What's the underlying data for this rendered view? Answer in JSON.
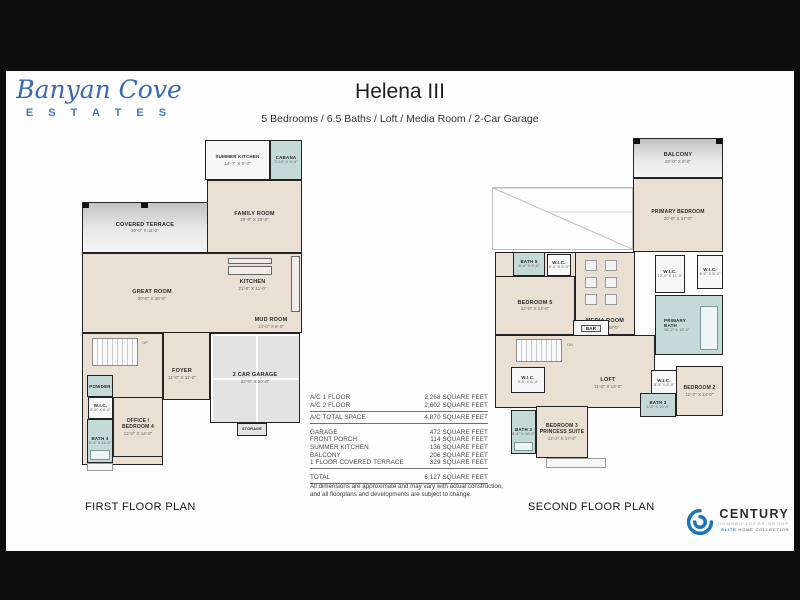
{
  "colors": {
    "brand_blue": "#3a68b5",
    "century_blue": "#1b75bc",
    "room_beige": "#e9e0d3",
    "bath_teal": "#c3dad6"
  },
  "brand": {
    "line1": "Banyan Cove",
    "line2": "E S T A T E S"
  },
  "header": {
    "title": "Helena III",
    "subtitle": "5 Bedrooms / 6.5 Baths / Loft / Media Room / 2-Car Garage"
  },
  "first_floor": {
    "caption": "FIRST FLOOR PLAN",
    "rooms": {
      "summer_kitchen": {
        "name": "SUMMER KITCHEN",
        "dims": "14'-7\" X 9'-4\""
      },
      "cabana": {
        "name": "CABANA",
        "dims": "5'-10\" X 9'-4\""
      },
      "covered_terrace": {
        "name": "COVERED TERRACE",
        "dims": "30'-0\" X 11'-2\""
      },
      "family_room": {
        "name": "FAMILY ROOM",
        "dims": "20'-0\" X 20'-0\""
      },
      "great_room": {
        "name": "GREAT ROOM",
        "dims": "20'-6\" X 20'-6\""
      },
      "kitchen": {
        "name": "KITCHEN",
        "dims": "21'-0\" X 11'-0\""
      },
      "mud_room": {
        "name": "MUD ROOM",
        "dims": "14'-0\" X 6'-0\""
      },
      "foyer": {
        "name": "FOYER",
        "dims": "11'-0\" X 11'-0\""
      },
      "garage": {
        "name": "2  CAR GARAGE",
        "dims": "22'-0\" X 20'-0\""
      },
      "storage": {
        "name": "STORAGE"
      },
      "powder": {
        "name": "POWDER"
      },
      "wic": {
        "name": "W.I.C.",
        "dims": "5'-8\" X 6'-0\""
      },
      "bath4": {
        "name": "BATH 4",
        "dims": "5'-4\" X 11'-0\""
      },
      "office": {
        "name1": "OFFICE /",
        "name2": "BEDROOM 4",
        "dims": "12'-0\" X 14'-0\""
      },
      "up": "UP"
    }
  },
  "second_floor": {
    "caption": "SECOND FLOOR PLAN",
    "rooms": {
      "balcony": {
        "name": "BALCONY",
        "dims": "20'-0\" X 8'-0\""
      },
      "primary_bedroom": {
        "name": "PRIMARY BEDROOM",
        "dims": "20'-8\" X 17'-0\""
      },
      "bath5": {
        "name": "BATH 5",
        "dims": "6'-4\" X 9'-0\""
      },
      "wic5": {
        "name": "W.I.C.",
        "dims": "6'-0\" X 5'-0\""
      },
      "bedroom5": {
        "name": "BEDROOM 5",
        "dims": "12'-0\" X 14'-0\""
      },
      "media_room": {
        "name": "MEDIA ROOM",
        "dims": "18'-4\" X 18'-0\""
      },
      "wic_primary_1": {
        "name": "W.I.C.",
        "dims": "12'-0\" X 11'-0\""
      },
      "wic_primary_2": {
        "name": "W.I.C.",
        "dims": "6'-2\" X 5'-0\""
      },
      "primary_bath": {
        "name": "PRIMARY",
        "name2": "BATH",
        "dims": "16'-2\" X 12'-0\""
      },
      "bar": {
        "name": "BAR"
      },
      "loft": {
        "name": "LOFT",
        "dims": "11'-0\" X 13'-0\""
      },
      "wic_left": {
        "name": "W.I.C.",
        "dims": "9'-0\" X 6'-4\""
      },
      "wic_mid": {
        "name": "W.I.C.",
        "dims": "8'-4\" X 5'-0\""
      },
      "bedroom2": {
        "name": "BEDROOM 2",
        "dims": "11'-2\" X 14'-0\""
      },
      "bath2": {
        "name": "BATH 2",
        "dims": "6'-0\" X 10'-0\""
      },
      "bedroom3": {
        "name1": "BEDROOM 3",
        "name2": "PRINCESS SUITE",
        "dims": "12'-2\" X 17'-2\""
      },
      "bath3": {
        "name": "BATH 3",
        "dims": "5'-4\" X 10'-0\""
      },
      "dn": "DN"
    }
  },
  "area_table": {
    "rows": [
      {
        "label": "A/C 1 FLOOR",
        "value": "2,268 SQUARE FEET"
      },
      {
        "label": "A/C 2 FLOOR",
        "value": "2,602 SQUARE FEET"
      },
      {
        "label": "A/C TOTAL SPACE",
        "value": "4,870 SQUARE FEET"
      },
      {
        "label": "GARAGE",
        "value": "472 SQUARE FEET"
      },
      {
        "label": "FRONT PORCH",
        "value": "114 SQUARE FEET"
      },
      {
        "label": "SUMMER KITCHEN",
        "value": "136 SQUARE FEET"
      },
      {
        "label": "BALCONY",
        "value": "206 SQUARE FEET"
      },
      {
        "label": "1 FLOOR COVERED TERRACE",
        "value": "329 SQUARE FEET"
      },
      {
        "label": "TOTAL",
        "value": "6,127 SQUARE FEET"
      }
    ]
  },
  "disclaimer": {
    "line1": "All dimensions are approximate and may vary with actual construction,",
    "line2": "and all floorplans and developments are subject to change."
  },
  "century": {
    "name": "CENTURY",
    "tagline1": "HOMEBUILDERS GROUP",
    "tagline2_blue": "ELITE",
    "tagline2_rest": " HOME COLLECTION"
  }
}
